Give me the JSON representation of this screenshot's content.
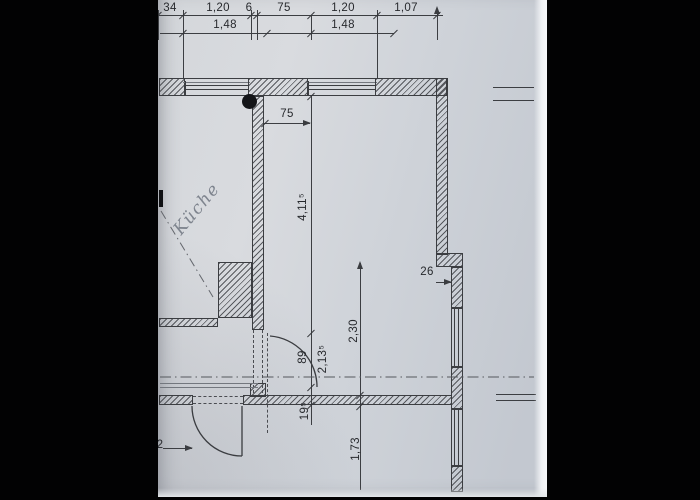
{
  "photo": {
    "kind": "architectural floor plan photograph",
    "letterbox_color": "#020203",
    "paper_color": "#d2d5db",
    "ink_color": "#3a3c40",
    "pencil_color": "#7e848e"
  },
  "room": {
    "label": "Küche"
  },
  "top_chain": {
    "row1": [
      "34",
      "1,20",
      "6",
      "75",
      "1,20",
      "1,07"
    ],
    "row2": [
      "1,48",
      "1,48"
    ]
  },
  "dims": {
    "opening_75": "75",
    "length_4115": "4,11⁵",
    "door_89": "89",
    "length_2135": "2,13⁵",
    "wall_195": "19⁵",
    "length_230": "2,30",
    "length_173": "1,73",
    "jog_26": "26",
    "partial_2": "2"
  }
}
